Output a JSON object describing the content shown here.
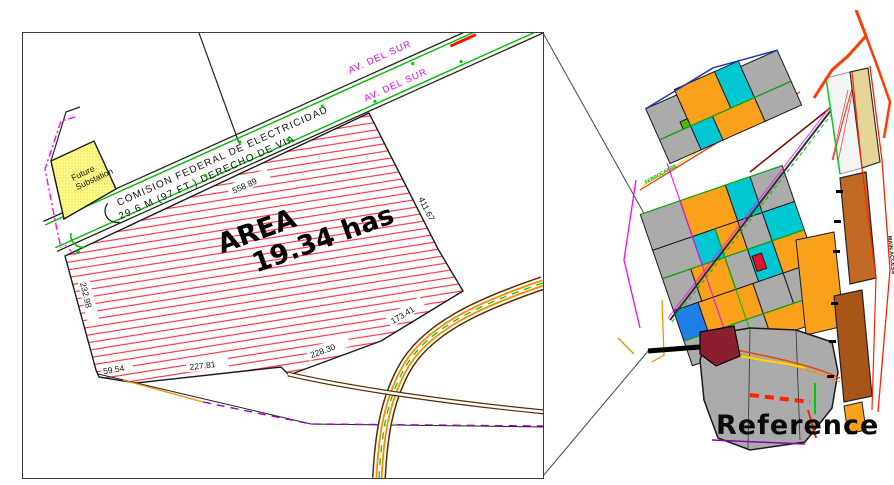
{
  "detail_view": {
    "parcel": {
      "area_title": "AREA",
      "area_value": "19.34 has"
    },
    "future_substation": {
      "line1": "Future",
      "line2": "Substation"
    },
    "cfe_corridor": {
      "owner": "COMISION FEDERAL DE ELECTRICIDAD",
      "right_of_way": "29.6 M (97 FT.) DERECHO DE VIA"
    },
    "road": {
      "name_upper": "AV. DEL SUR",
      "name_lower": "AV. DEL SUR"
    },
    "dimensions": {
      "top_edge": "558.89",
      "east_edge": "411.67",
      "west_edge": "232.98",
      "south_edge_a": "227.81",
      "west_step": "59.54",
      "south_edge_b": "228.30",
      "south_edge_c": "173.41"
    },
    "colors": {
      "hatch_red": "#FF3040",
      "substation_yellow": "#FFFB8C",
      "row_green": "#00BB00",
      "boundary_magenta": "#FF00FF",
      "road_orange": "#FF8A00",
      "track_brown": "#5A2D00"
    }
  },
  "reference_map": {
    "title": "Reference",
    "labels": {
      "main_access": "MAIN ACCESS",
      "railroad": "FERROCARRIL"
    },
    "palette": {
      "parcel_orange": "#F9A11B",
      "parcel_cyan": "#00C8D2",
      "parcel_gray": "#ABABAB",
      "subject_maroon": "#8B1F2F",
      "parcel_blue": "#1E7FE8",
      "rail_tan": "#E6D598",
      "road_brown": "#C06A25",
      "highway_red": "#FF3C00",
      "accent_green": "#00BB00",
      "accent_red": "#E8112D"
    }
  }
}
